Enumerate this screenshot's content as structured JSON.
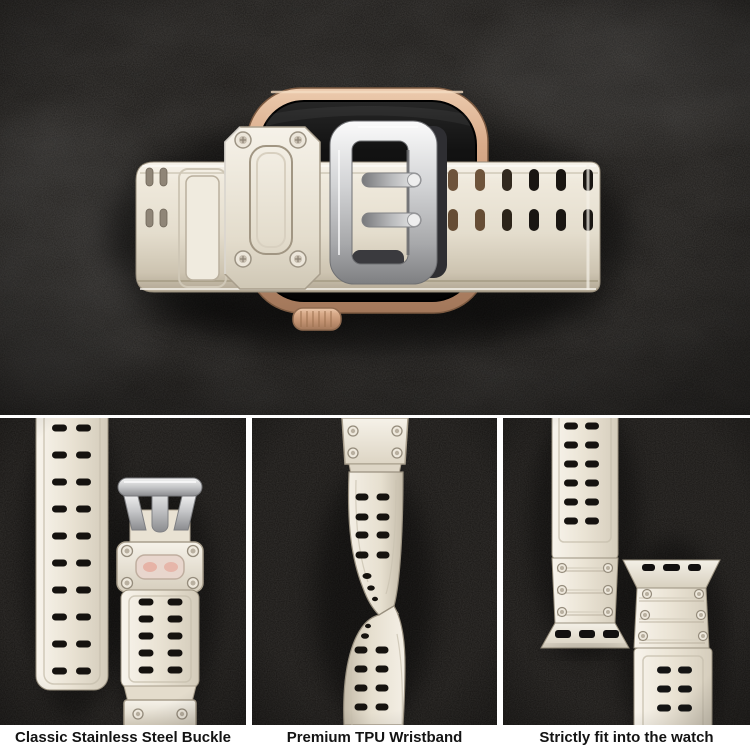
{
  "captions": [
    {
      "id": "buckle",
      "label": "Classic Stainless Steel Buckle"
    },
    {
      "id": "wristband",
      "label": "Premium TPU Wristband"
    },
    {
      "id": "fit",
      "label": "Strictly fit into the watch"
    }
  ],
  "colors": {
    "background_dark": "#181614",
    "divider_white": "#ffffff",
    "caption_text": "#131313",
    "band_ivory": "#e9e2d4",
    "band_highlight": "#f7f3ea",
    "band_shadow": "#b4aa99",
    "buckle_silver": "#d2d3d5",
    "watch_case_gold": "#c99d7c",
    "watch_screen_black": "#0c0c0c",
    "strap_hole_dark": "#1a1612",
    "strap_hole_gold": "#6e543c"
  }
}
